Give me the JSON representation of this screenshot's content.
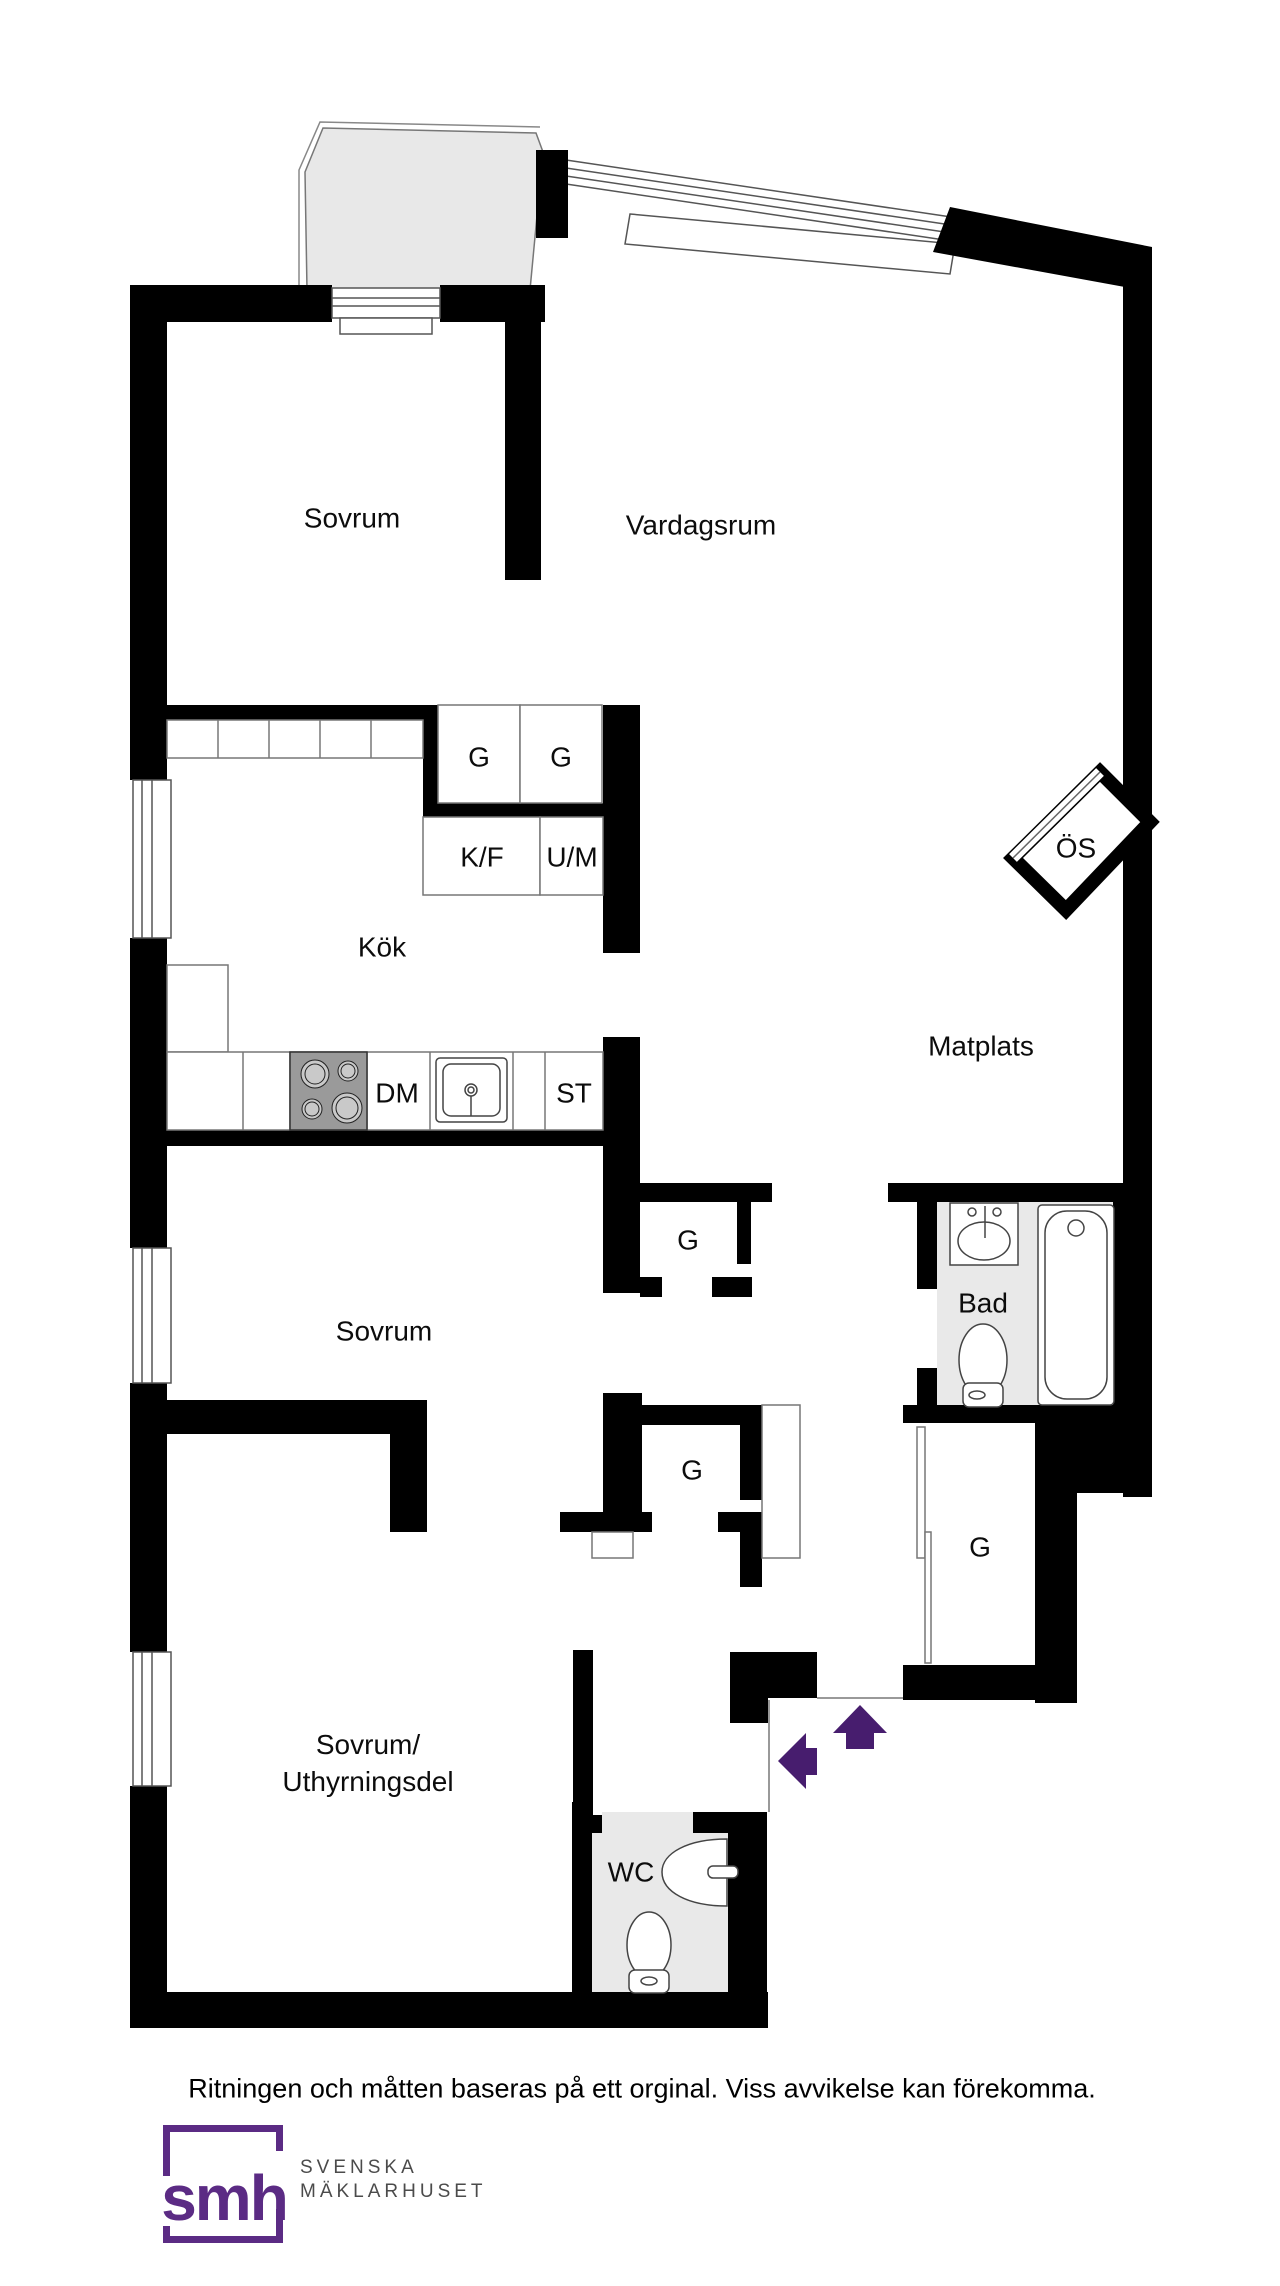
{
  "rooms": {
    "sovrum1": "Sovrum",
    "vardagsrum": "Vardagsrum",
    "kok": "Kök",
    "matplats": "Matplats",
    "sovrum2": "Sovrum",
    "sovrum3_line1": "Sovrum/",
    "sovrum3_line2": "Uthyrningsdel",
    "bad": "Bad",
    "wc": "WC",
    "os": "ÖS"
  },
  "fixtures": {
    "g_kitchen_1": "G",
    "g_kitchen_2": "G",
    "kf": "K/F",
    "um": "U/M",
    "dm": "DM",
    "st": "ST",
    "g_hall_1": "G",
    "g_hall_2": "G",
    "g_right": "G"
  },
  "footer": {
    "disclaimer": "Ritningen och måtten baseras på ett orginal. Viss avvikelse kan förekomma.",
    "logo_mark": "smh",
    "logo_line1": "SVENSKA",
    "logo_line2": "MÄKLARHUSET"
  },
  "colors": {
    "wall": "#000000",
    "balcony_floor": "#e8e8e8",
    "bath_floor": "#e9e9e9",
    "arrow_purple": "#471d6e",
    "logo_purple": "#5b2b84",
    "logo_gray": "#4b4b4b",
    "stove_gray": "#9a9a9a"
  }
}
